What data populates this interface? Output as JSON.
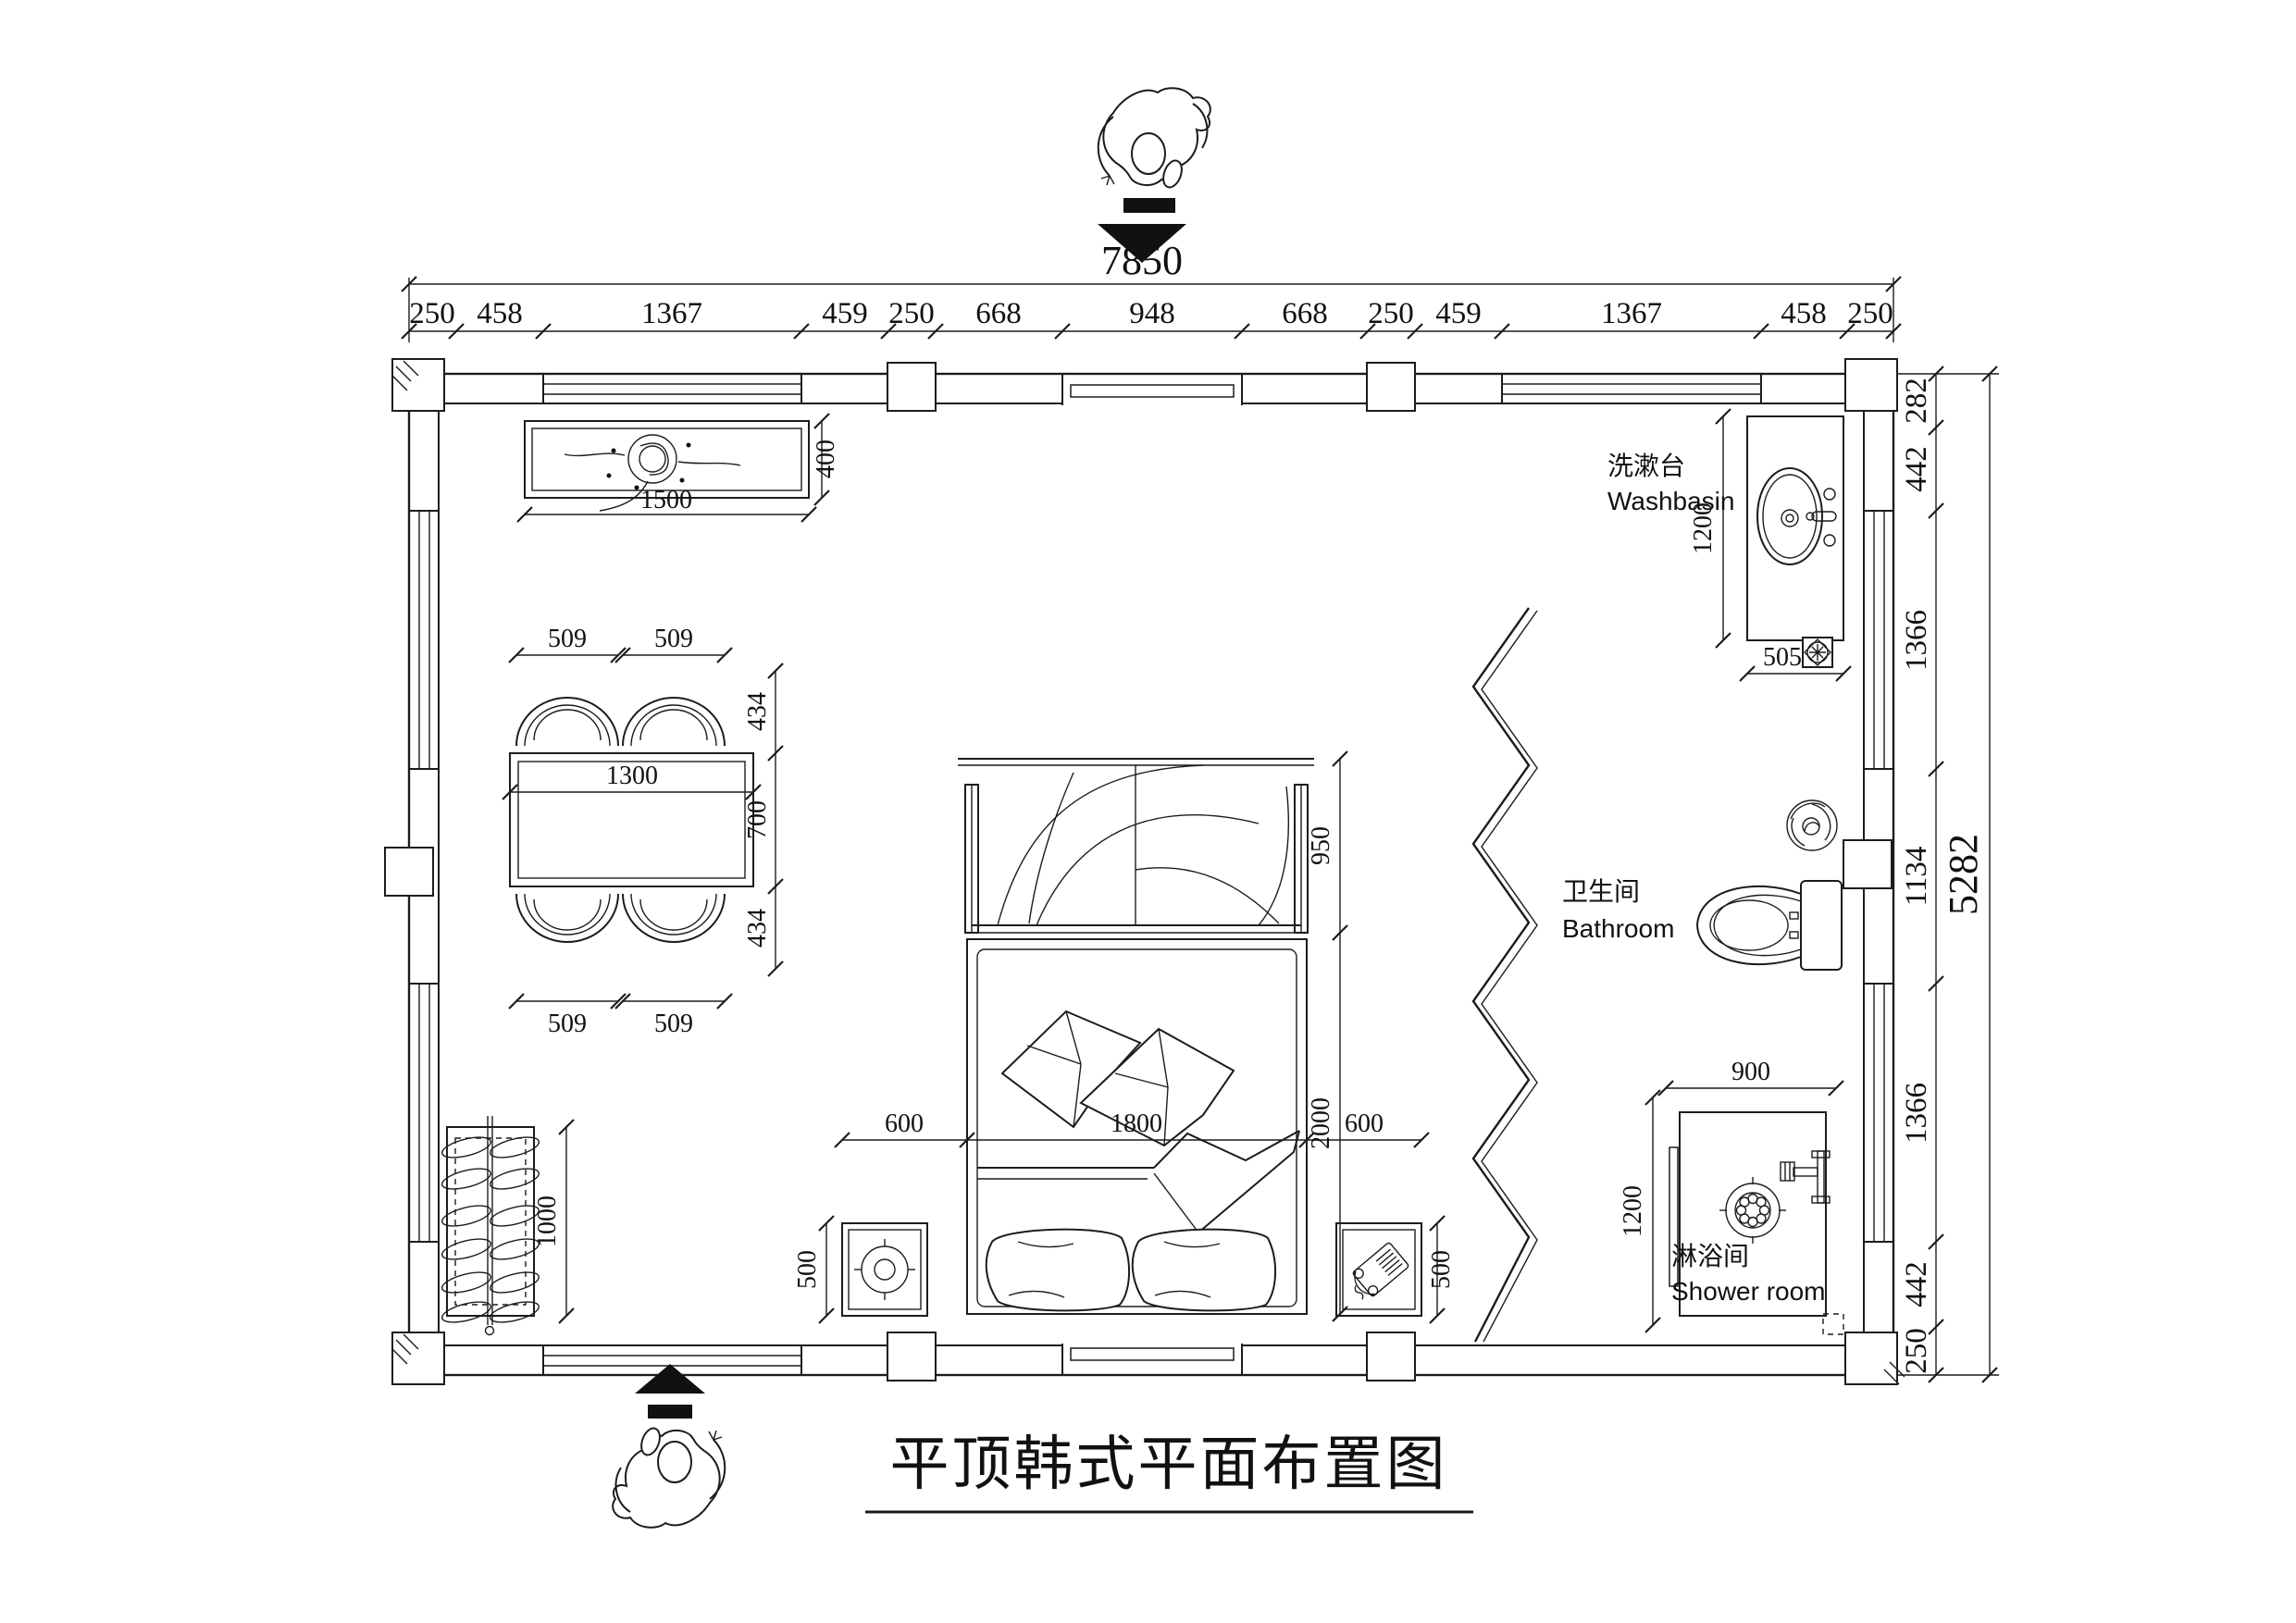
{
  "drawing": {
    "title": "平顶韩式平面布置图"
  },
  "dimensions": {
    "top_total": "7850",
    "top_chain": [
      "250",
      "458",
      "1367",
      "459",
      "250",
      "668",
      "948",
      "668",
      "250",
      "459",
      "1367",
      "458",
      "250"
    ],
    "right_total": "5282",
    "right_chain": [
      "282",
      "442",
      "1366",
      "1134",
      "1366",
      "442",
      "250"
    ]
  },
  "rooms": {
    "washbasin": {
      "name_zh": "洗漱台",
      "name_en": "Washbasin",
      "counter_length": "1200",
      "counter_width": "505"
    },
    "bathroom": {
      "name_zh": "卫生间",
      "name_en": "Bathroom"
    },
    "shower": {
      "name_zh": "淋浴间",
      "name_en": "Shower room",
      "width": "900",
      "depth": "1200"
    }
  },
  "furniture": {
    "ceiling_lamp_panel": {
      "length": "1500",
      "width": "400"
    },
    "dining_table": {
      "length": "1300",
      "width": "700",
      "chair_width": "509",
      "chair_depth": "434"
    },
    "shoe_rack": {
      "length": "1000"
    },
    "bed": {
      "side_left": "600",
      "width": "1800",
      "side_right": "600",
      "length": "2000",
      "headboard_screen": "950",
      "nightstand_depth": "500"
    }
  }
}
